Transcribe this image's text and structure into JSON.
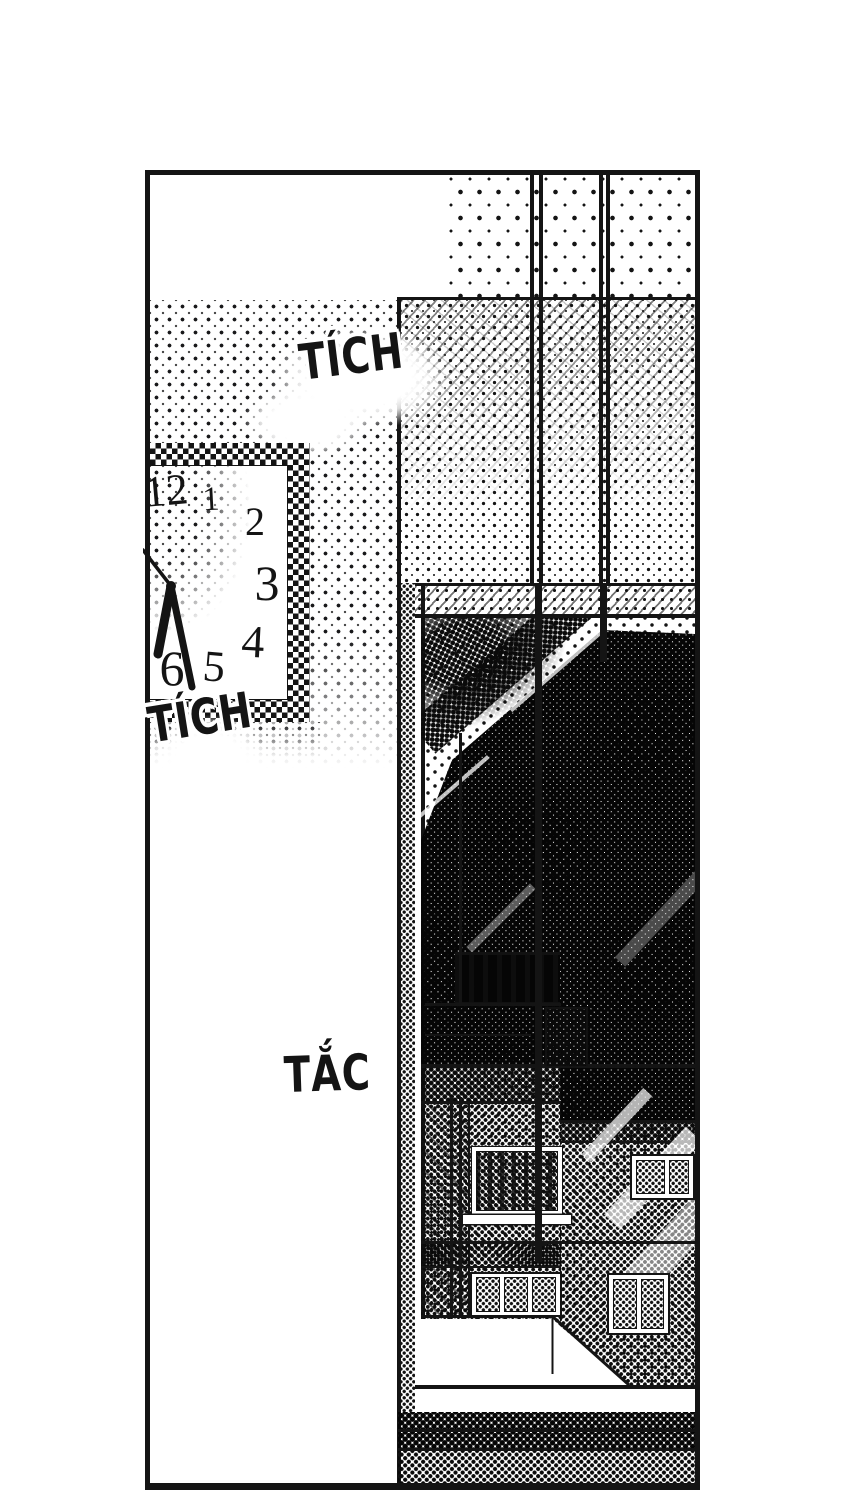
{
  "colors": {
    "ink": "#141414",
    "paper": "#ffffff"
  },
  "sfx": {
    "tick_top": "TÍCH",
    "tick_clock": "TÍCH",
    "tock": "TẮC"
  },
  "clock": {
    "numerals": [
      "12",
      "1",
      "2",
      "3",
      "4",
      "5",
      "6"
    ]
  }
}
